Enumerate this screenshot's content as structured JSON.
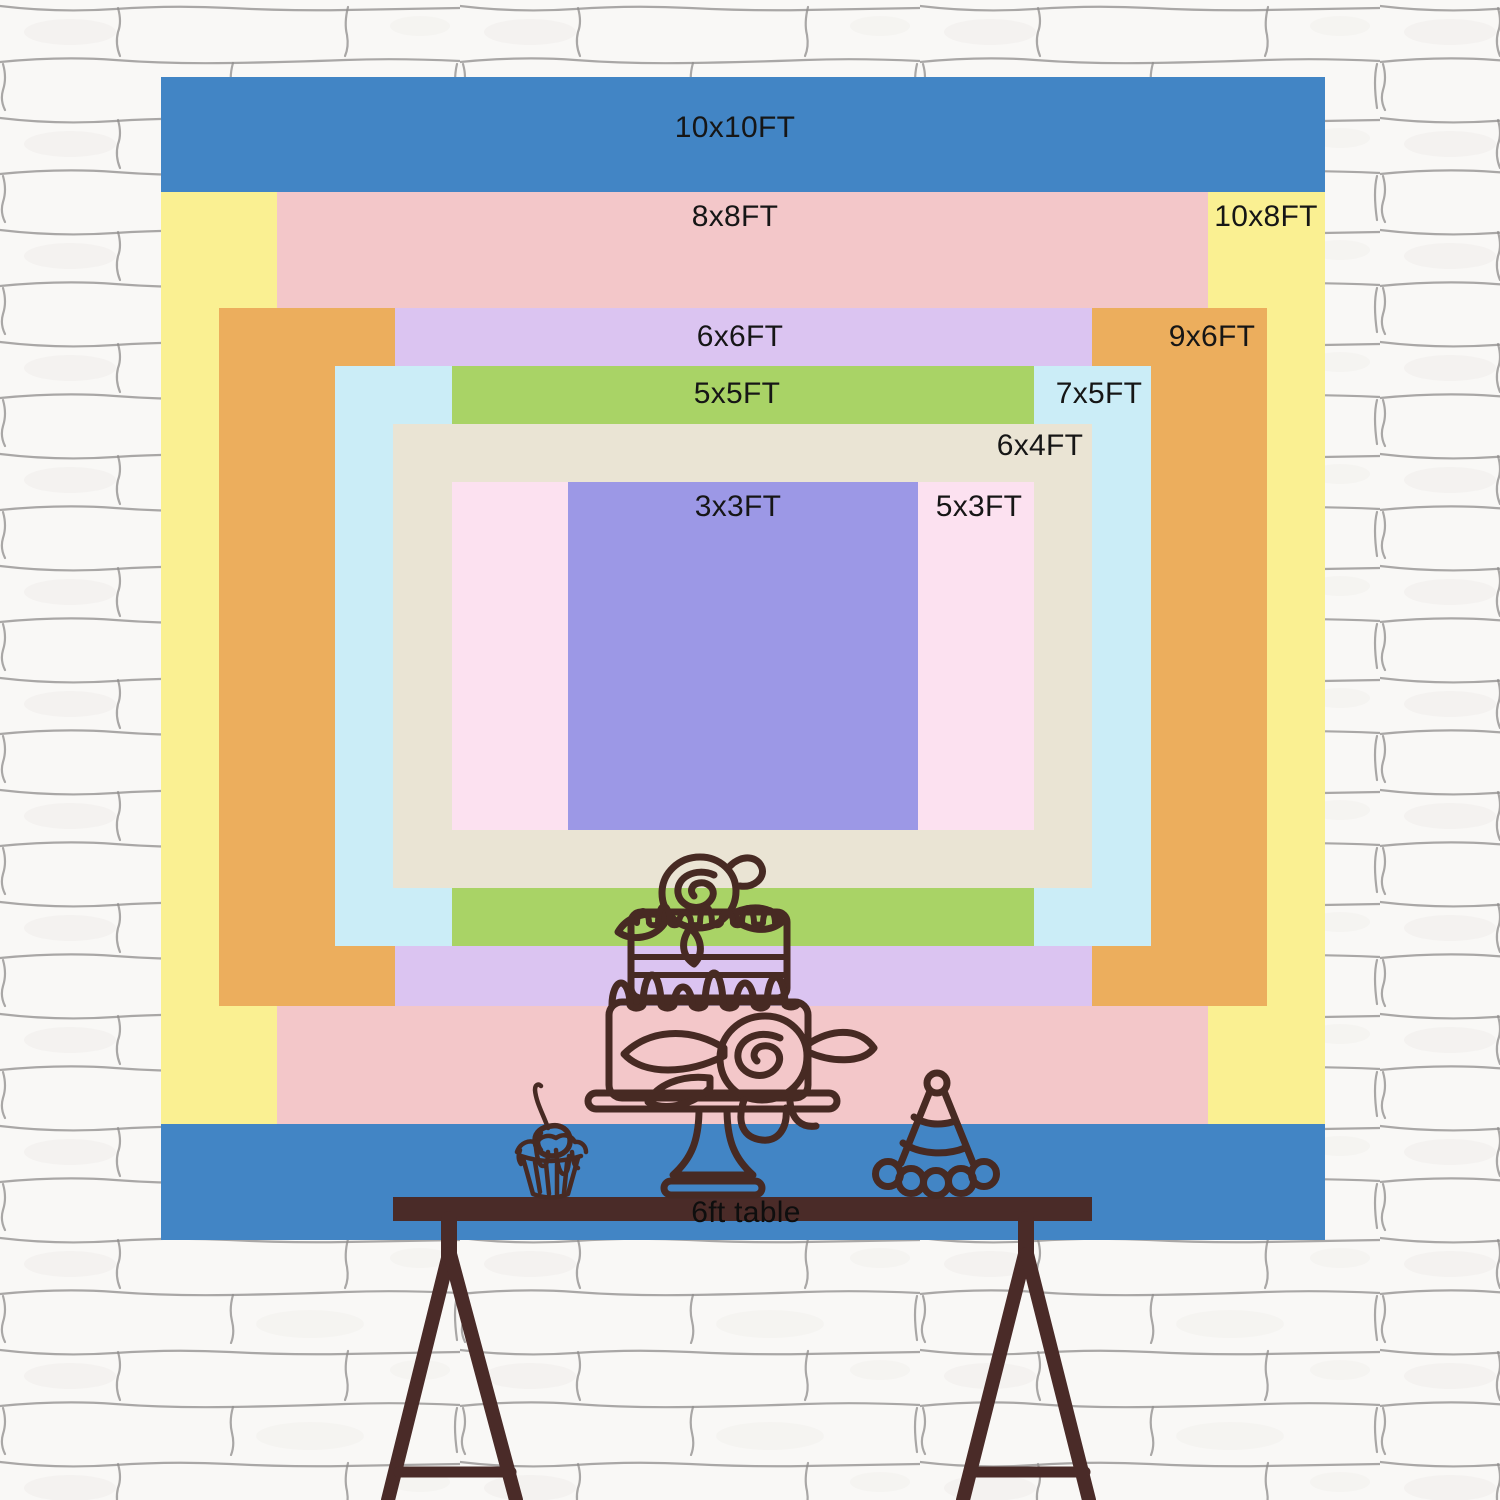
{
  "wall": {
    "base_color": "#f9f8f6",
    "mortar_color": "#8e8c8a"
  },
  "artwork": {
    "ink_color": "#472a23"
  },
  "backdrop": {
    "sizes": [
      {
        "label": "10x10FT",
        "color": "#4285C5"
      },
      {
        "label": "10x8FT",
        "color": "#FAF092"
      },
      {
        "label": "8x8FT",
        "color": "#F3C7C9"
      },
      {
        "label": "9x6FT",
        "color": "#ECAE5D"
      },
      {
        "label": "6x6FT",
        "color": "#DBC4F1"
      },
      {
        "label": "7x5FT",
        "color": "#CBEDF7"
      },
      {
        "label": "5x5FT",
        "color": "#A9D366"
      },
      {
        "label": "6x4FT",
        "color": "#EAE4D4"
      },
      {
        "label": "5x3FT",
        "color": "#FCE1F0"
      },
      {
        "label": "3x3FT",
        "color": "#9C98E6"
      }
    ],
    "decorations": [
      "cake",
      "cupcake",
      "party-hat"
    ]
  },
  "table": {
    "label": "6ft table",
    "color": "#4A2B28"
  }
}
